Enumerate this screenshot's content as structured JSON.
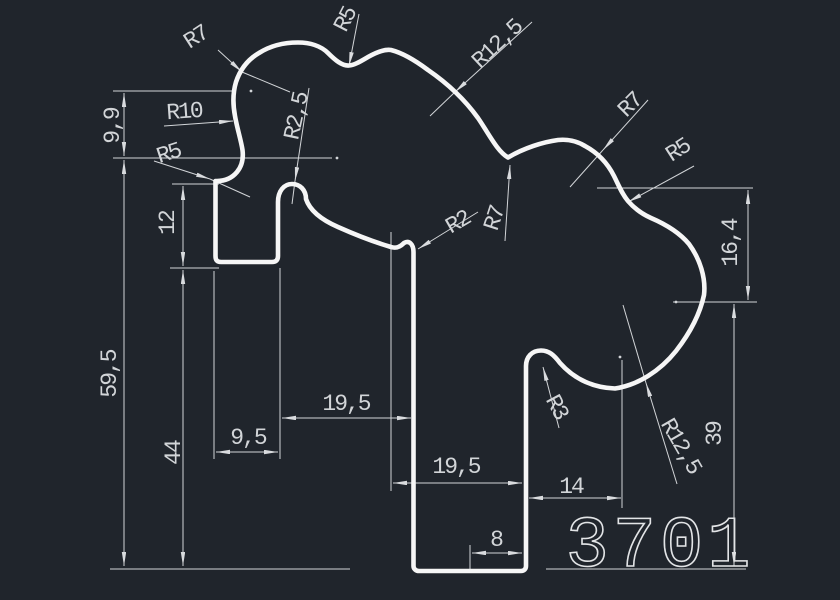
{
  "drawing_type": "cad-profile-drawing",
  "canvas": {
    "background": "#20252c",
    "profile_color": "#f6f6f6",
    "dimension_color": "#d2d5d8"
  },
  "part_number": "3701",
  "labels": {
    "radius": {
      "top_left_r7": "R7",
      "top_r5": "R5",
      "top_r12_5": "R12,5",
      "r10": "R10",
      "r2_5": "R2,5",
      "left_r5": "R5",
      "right_r7": "R7",
      "right_r5": "R5",
      "r2": "R2",
      "mid_r7": "R7",
      "r3": "R3",
      "bottom_r12_5": "R12,5"
    },
    "linear": {
      "v9_9": "9,9",
      "v12": "12",
      "v59_5": "59,5",
      "v44": "44",
      "h9_5": "9,5",
      "h19_5_upper": "19,5",
      "h19_5_lower": "19,5",
      "h8": "8",
      "h14": "14",
      "v16_4": "16,4",
      "v39": "39"
    }
  }
}
